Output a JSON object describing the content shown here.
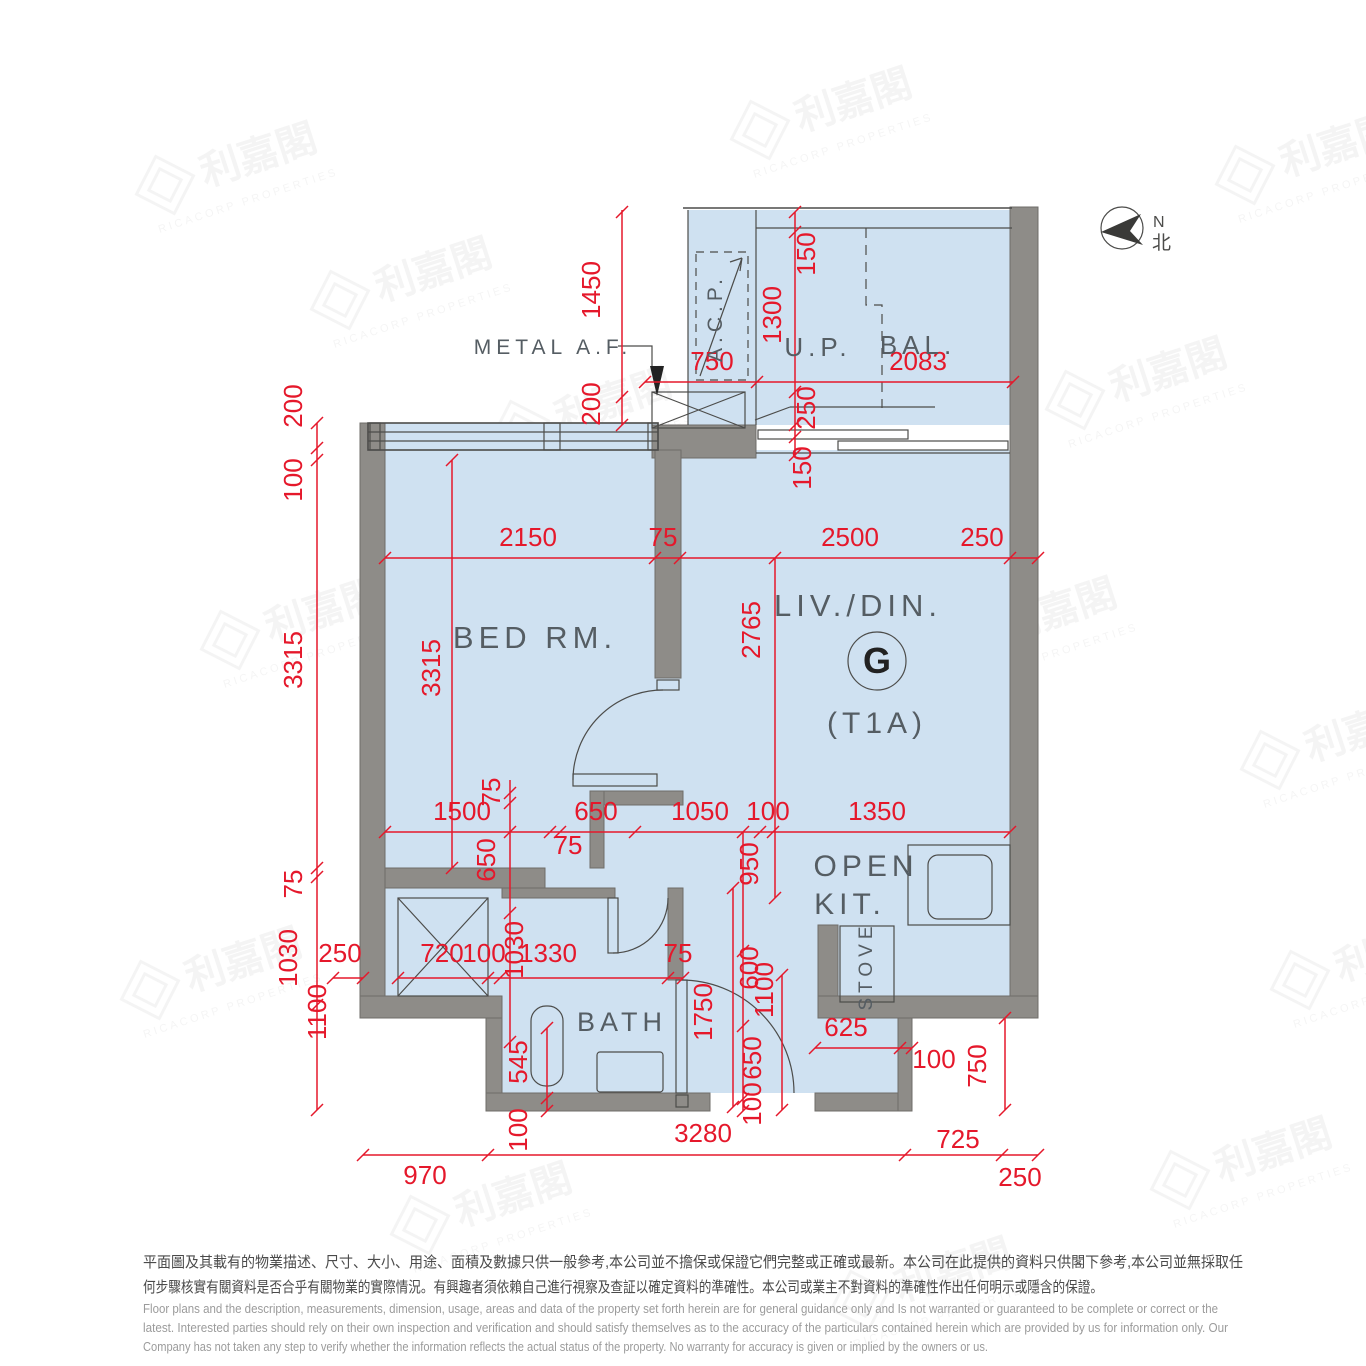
{
  "north": {
    "en": "N",
    "zh": "北"
  },
  "rooms": {
    "bed_rm": "BED RM.",
    "liv_din": "LIV./DIN.",
    "flat": "G",
    "tower": "(T1A)",
    "up": "U.P.",
    "bal": "BAL.",
    "acp": "A.C.P.",
    "open": "OPEN",
    "kit": "KIT.",
    "stove": "STOVE",
    "bath": "BATH",
    "metal_af": "METAL A.F."
  },
  "dimensions": [
    {
      "t": "1450",
      "x": 600,
      "y": 290,
      "v": true
    },
    {
      "t": "200",
      "x": 600,
      "y": 404,
      "v": true
    },
    {
      "t": "750",
      "x": 712,
      "y": 370,
      "v": false
    },
    {
      "t": "2083",
      "x": 918,
      "y": 370,
      "v": false
    },
    {
      "t": "150",
      "x": 815,
      "y": 254,
      "v": true
    },
    {
      "t": "1300",
      "x": 781,
      "y": 315,
      "v": true
    },
    {
      "t": "250",
      "x": 815,
      "y": 408,
      "v": true
    },
    {
      "t": "150",
      "x": 811,
      "y": 468,
      "v": true
    },
    {
      "t": "200",
      "x": 302,
      "y": 406,
      "v": true
    },
    {
      "t": "100",
      "x": 302,
      "y": 480,
      "v": true
    },
    {
      "t": "3315",
      "x": 302,
      "y": 660,
      "v": true
    },
    {
      "t": "75",
      "x": 302,
      "y": 884,
      "v": true
    },
    {
      "t": "1030",
      "x": 297,
      "y": 958,
      "v": true
    },
    {
      "t": "250",
      "x": 340,
      "y": 962,
      "v": false
    },
    {
      "t": "1100",
      "x": 326,
      "y": 1012,
      "v": true
    },
    {
      "t": "2150",
      "x": 528,
      "y": 546,
      "v": false
    },
    {
      "t": "75",
      "x": 663,
      "y": 546,
      "v": false
    },
    {
      "t": "2500",
      "x": 850,
      "y": 546,
      "v": false
    },
    {
      "t": "250",
      "x": 982,
      "y": 546,
      "v": false
    },
    {
      "t": "3315",
      "x": 440,
      "y": 668,
      "v": true
    },
    {
      "t": "2765",
      "x": 760,
      "y": 630,
      "v": true
    },
    {
      "t": "1500",
      "x": 462,
      "y": 820,
      "v": false
    },
    {
      "t": "650",
      "x": 596,
      "y": 820,
      "v": false
    },
    {
      "t": "1050",
      "x": 700,
      "y": 820,
      "v": false
    },
    {
      "t": "100",
      "x": 768,
      "y": 820,
      "v": false
    },
    {
      "t": "1350",
      "x": 877,
      "y": 820,
      "v": false
    },
    {
      "t": "75",
      "x": 568,
      "y": 854,
      "v": false
    },
    {
      "t": "75",
      "x": 500,
      "y": 792,
      "v": true
    },
    {
      "t": "650",
      "x": 495,
      "y": 860,
      "v": true
    },
    {
      "t": "1030",
      "x": 523,
      "y": 950,
      "v": true
    },
    {
      "t": "950",
      "x": 758,
      "y": 864,
      "v": true
    },
    {
      "t": "600",
      "x": 758,
      "y": 968,
      "v": true
    },
    {
      "t": "650",
      "x": 761,
      "y": 1058,
      "v": true
    },
    {
      "t": "100",
      "x": 761,
      "y": 1104,
      "v": true
    },
    {
      "t": "1100",
      "x": 773,
      "y": 990,
      "v": true
    },
    {
      "t": "1750",
      "x": 712,
      "y": 1012,
      "v": true
    },
    {
      "t": "720",
      "x": 442,
      "y": 962,
      "v": false
    },
    {
      "t": "100",
      "x": 484,
      "y": 962,
      "v": false
    },
    {
      "t": "1330",
      "x": 548,
      "y": 962,
      "v": false
    },
    {
      "t": "75",
      "x": 678,
      "y": 962,
      "v": false
    },
    {
      "t": "545",
      "x": 527,
      "y": 1062,
      "v": true
    },
    {
      "t": "100",
      "x": 527,
      "y": 1130,
      "v": true
    },
    {
      "t": "625",
      "x": 846,
      "y": 1036,
      "v": false
    },
    {
      "t": "100",
      "x": 934,
      "y": 1068,
      "v": false
    },
    {
      "t": "750",
      "x": 986,
      "y": 1066,
      "v": true
    },
    {
      "t": "970",
      "x": 425,
      "y": 1184,
      "v": false
    },
    {
      "t": "3280",
      "x": 703,
      "y": 1142,
      "v": false
    },
    {
      "t": "725",
      "x": 958,
      "y": 1148,
      "v": false
    },
    {
      "t": "250",
      "x": 1020,
      "y": 1186,
      "v": false
    }
  ],
  "disclaimer": {
    "zh": [
      "平面圖及其載有的物業描述、尺寸、大小、用途、面積及數據只供一般參考,本公司並不擔保或保證它們完整或正確或最新。本公司在此提供的資料只供閣下參考,本公司並無採取任",
      "何步驟核實有關資料是否合乎有關物業的實際情況。有興趣者須依賴自己進行視察及查証以確定資料的準確性。本公司或業主不對資料的準確性作出任何明示或隱含的保證。"
    ],
    "en": [
      "Floor plans and the description, measurements, dimension, usage, areas and data of the property set forth herein are for general guidance only and Is not warranted or guaranteed to be complete or correct or the",
      "latest. Interested parties should rely on their own inspection and verification and should satisfy themselves as to the accuracy of the particulars contained herein which are provided by us for information only.  Our",
      "Company has not taken any step to verify whether the information reflects the actual status of the property.  No warranty for accuracy is given or implied by the owners or us."
    ]
  },
  "watermark": {
    "zh": "利嘉閣",
    "en": "RICACORP PROPERTIES"
  },
  "colors": {
    "dimension_red": "#e5182b",
    "floor_blue": "#cfe1f1",
    "wall_gray": "#8e8c88",
    "line_dark": "#4c4c4a"
  }
}
